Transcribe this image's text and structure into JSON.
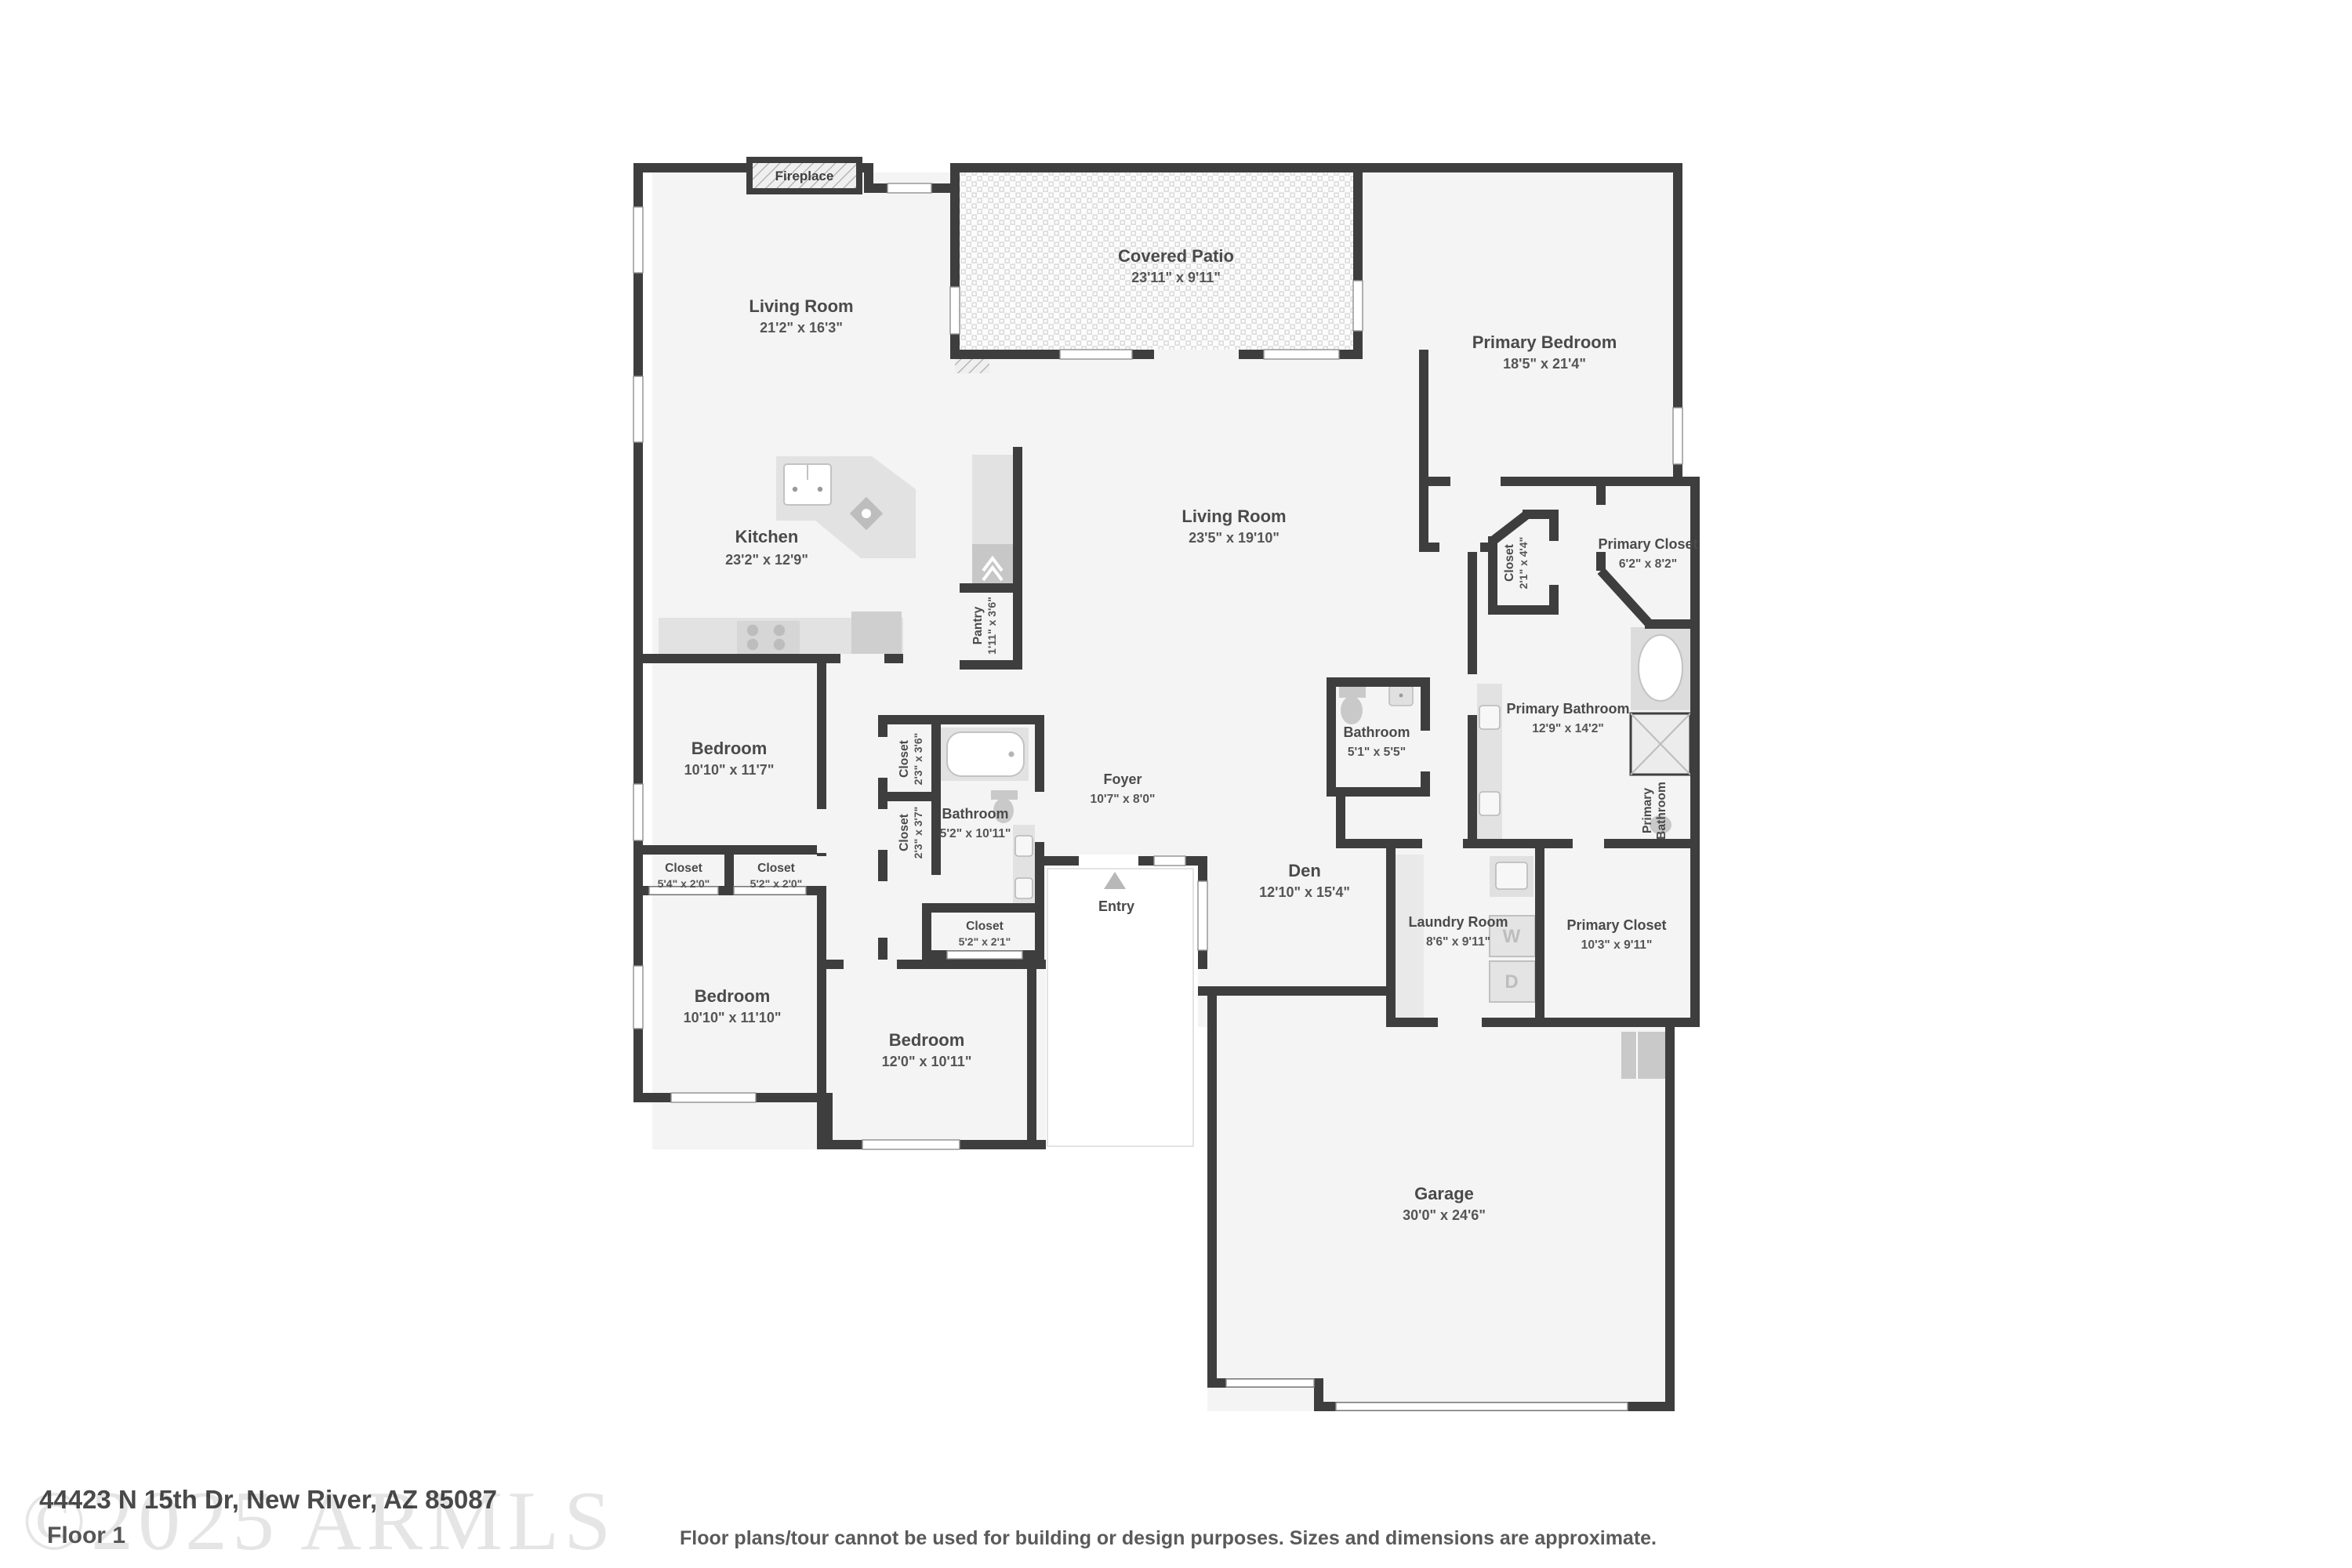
{
  "colors": {
    "wall": "#3e3e3e",
    "floor": "#f4f4f4",
    "fixture": "#cccccc",
    "patio_tile": "#dcdcdc"
  },
  "rooms": {
    "living_room_1": {
      "name": "Living Room",
      "dims": "21'2\" x 16'3\""
    },
    "covered_patio": {
      "name": "Covered Patio",
      "dims": "23'11\" x 9'11\""
    },
    "primary_bedroom": {
      "name": "Primary Bedroom",
      "dims": "18'5\" x 21'4\""
    },
    "living_room_2": {
      "name": "Living Room",
      "dims": "23'5\" x 19'10\""
    },
    "kitchen": {
      "name": "Kitchen",
      "dims": "23'2\" x 12'9\""
    },
    "pantry": {
      "name": "Pantry",
      "dims": "1'11\" x 3'6\""
    },
    "hall_closet": {
      "name": "Closet",
      "dims": "2'1\" x 4'4\""
    },
    "primary_closet_1": {
      "name": "Primary Closet",
      "dims": "6'2\" x 8'2\""
    },
    "primary_bathroom": {
      "name": "Primary Bathroom",
      "dims": "12'9\" x 14'2\""
    },
    "bathroom_1": {
      "name": "Bathroom",
      "dims": "5'1\" x 5'5\""
    },
    "bedroom_1": {
      "name": "Bedroom",
      "dims": "10'10\" x 11'7\""
    },
    "closet_1": {
      "name": "Closet",
      "dims": "2'3\" x 3'6\""
    },
    "closet_2": {
      "name": "Closet",
      "dims": "2'3\" x 3'7\""
    },
    "bathroom_2": {
      "name": "Bathroom",
      "dims": "5'2\" x 10'11\""
    },
    "foyer": {
      "name": "Foyer",
      "dims": "10'7\" x 8'0\""
    },
    "den": {
      "name": "Den",
      "dims": "12'10\" x 15'4\""
    },
    "closet_3": {
      "name": "Closet",
      "dims": "5'4\" x 2'0\""
    },
    "closet_4": {
      "name": "Closet",
      "dims": "5'2\" x 2'0\""
    },
    "bedroom_2": {
      "name": "Bedroom",
      "dims": "10'10\" x 11'10\""
    },
    "closet_5": {
      "name": "Closet",
      "dims": "5'2\" x 2'1\""
    },
    "bedroom_3": {
      "name": "Bedroom",
      "dims": "12'0\" x 10'11\""
    },
    "laundry_room": {
      "name": "Laundry Room",
      "dims": "8'6\" x 9'11\""
    },
    "primary_closet_2": {
      "name": "Primary Closet",
      "dims": "10'3\" x 9'11\""
    },
    "primary_bathroom_wc": {
      "line1": "Primary",
      "line2": "Bathroom"
    },
    "garage": {
      "name": "Garage",
      "dims": "30'0\" x 24'6\""
    }
  },
  "labels": {
    "fireplace": "Fireplace",
    "entry": "Entry",
    "washer": "W",
    "dryer": "D"
  },
  "footer": {
    "watermark": "©2025 ARMLS",
    "address": "44423 N 15th Dr, New River, AZ 85087",
    "floor_label": "Floor 1",
    "disclaimer": "Floor plans/tour cannot be used for building or design purposes. Sizes and dimensions are approximate."
  }
}
